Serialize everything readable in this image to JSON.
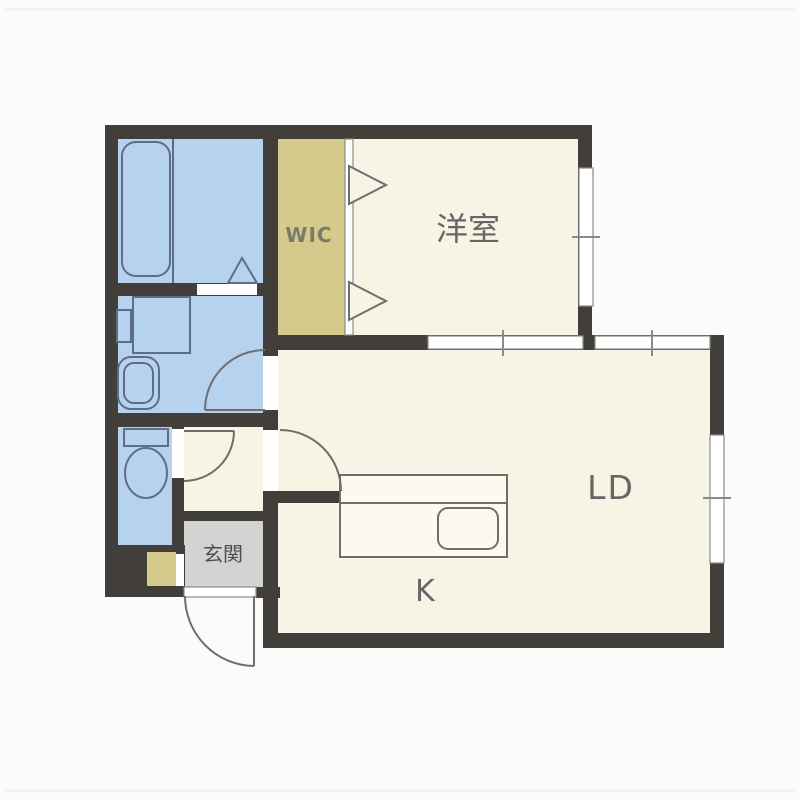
{
  "colors": {
    "background": "#fbfbfb",
    "wall": "#423e39",
    "wet": "#b7d2ef",
    "room": "#f8f4e5",
    "closet": "#d6c98c",
    "entry": "#d3d3d3",
    "window": "#ffffff",
    "window_stroke": "#8a8a8a",
    "outline": "#6e6e6e",
    "wet_outline": "#5d6e86",
    "counter": "#fcf9ee",
    "text": "#666666",
    "entry_text": "#4d4d4d",
    "wic_text": "#7b7b6c"
  },
  "labels": {
    "wic": "WIC",
    "western_room": "洋室",
    "living_dining": "LD",
    "kitchen": "K",
    "entrance": "玄関"
  }
}
